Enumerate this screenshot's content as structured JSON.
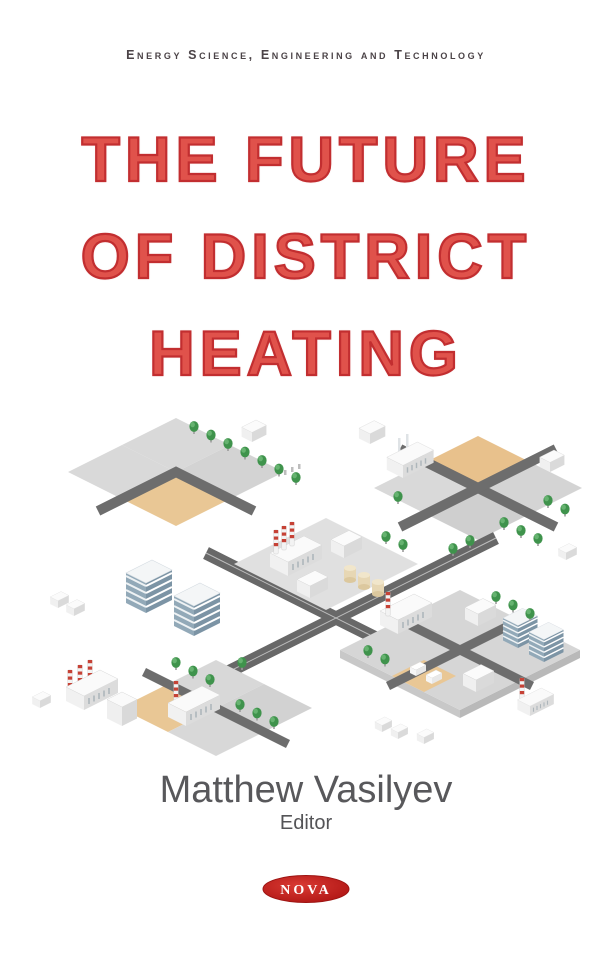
{
  "series_banner": {
    "text": "Energy Science, Engineering and Technology"
  },
  "title": {
    "line1": "THE FUTURE",
    "line2": "OF DISTRICT",
    "line3": "HEATING"
  },
  "author": {
    "name": "Matthew Vasilyev",
    "role": "Editor"
  },
  "publisher": {
    "name": "NOVA"
  },
  "colors": {
    "title_red_stroke": "#c22e30",
    "title_red_fill": "#e0524b",
    "series_text": "#4b4347",
    "author_gray": "#58585b",
    "logo_red": "#b51716",
    "ground_gray": "#d8d8d8",
    "sand_tan": "#e9c795",
    "road_dark": "#6d6d6d",
    "tree_green": "#3f934c",
    "office_blue": "#7c94a5",
    "chimney_stripe_red": "#c64236"
  },
  "illustration": {
    "alt": "Isometric city district with factories, striped smokestacks, office buildings, crossing roads, trees, sand lots and small trucks"
  }
}
